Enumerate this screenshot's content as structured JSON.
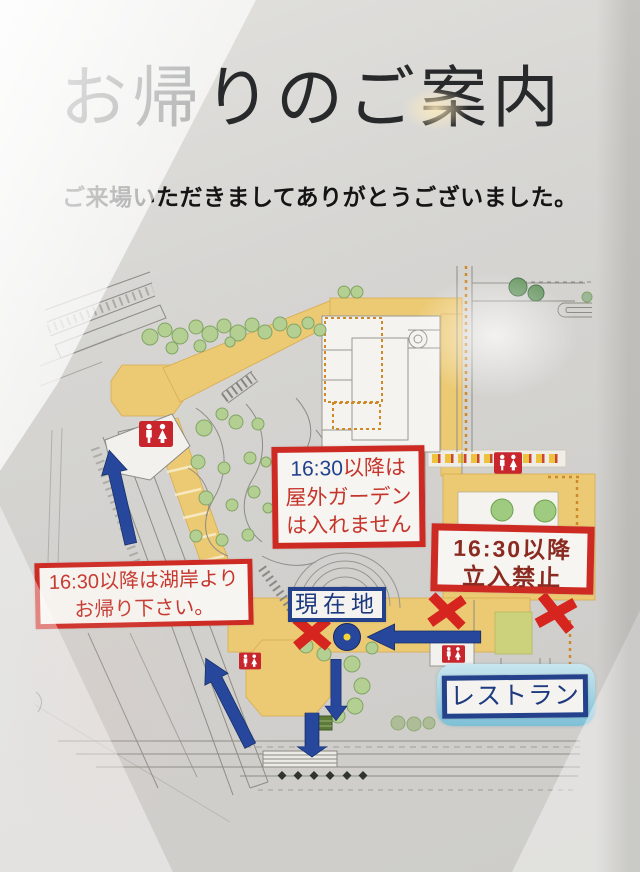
{
  "poster": {
    "title": "お帰りのご案内",
    "thanks": "ご来場いただきましてありがとうございました。"
  },
  "notices": {
    "garden": {
      "time": "16:30",
      "line1_rest": "以降は",
      "line2": "屋外ガーデン",
      "line3": "は入れません"
    },
    "no_entry": {
      "line1": "16:30以降",
      "line2": "立入禁止"
    },
    "lakeside": {
      "line1": "16:30以降は湖岸より",
      "line2": "お帰り下さい。"
    }
  },
  "map": {
    "current_location": "現在地",
    "restaurant": "レストラン",
    "icons": {
      "restroom": "restroom-icon (white male/female pictogram on red square), 4 locations",
      "current_location_marker": "navy circle with yellow center dot",
      "route_arrow": "navy blue directional arrow, 5 on map",
      "closed_mark": "red X mark, 3 on map"
    },
    "colors": {
      "notice_red": "#cd2a23",
      "navy": "#24418c",
      "path_tan": "#ecca74",
      "tree_green": "#b3cf92",
      "restaurant_highlight": "#a7d6e6",
      "road_gray": "#8d8c85"
    }
  }
}
